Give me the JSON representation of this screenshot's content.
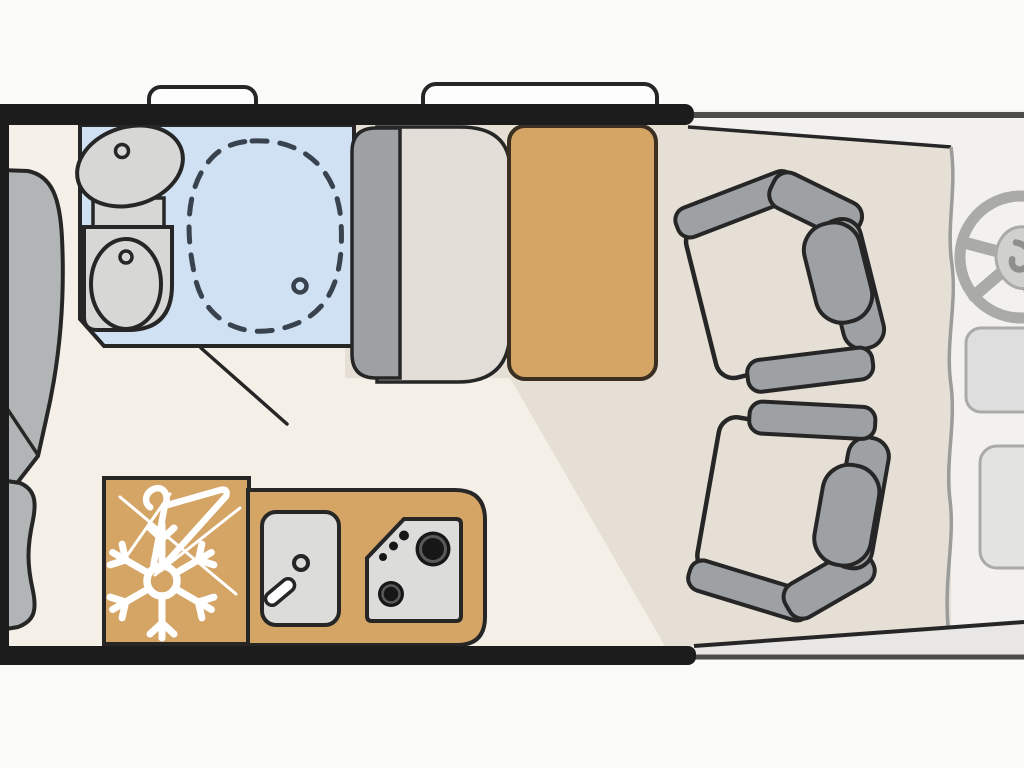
{
  "canvas": {
    "width": 1024,
    "height": 768,
    "description": "Motorhome floor plan, top view; vehicle front (cab) on the right, rear bed on the left, no visible text labels"
  },
  "palette": {
    "background": "#fbfbfa",
    "wall": "#1c1c1c",
    "outline": "#262626",
    "table_outline": "#3a2f20",
    "floor_cream": "#f5f0e7",
    "floor_beige": "#e5dfd5",
    "bathroom_blue": "#cfe1f2",
    "furniture_orange": "#d5a566",
    "seat_gray": "#9da1a3",
    "cushion_gray": "#e2ded7",
    "bed_gray": "#b2b5b5",
    "fixture_gray": "#d7d7d5",
    "appliance_steel": "#dcdcda",
    "burner_black": "#171717",
    "burner_ring": "#5a5a5a",
    "cab_gray": "#f2f1ef",
    "cab_line_gray": "#aaaaa8",
    "trim_line": "#4c4c4a",
    "edge_gray": "#9c9c9a",
    "step_gray": "#e8e7e5",
    "shower_dash": "#39424f",
    "icon_white": "#ffffff",
    "window_white": "#fdfdfd"
  },
  "regions": {
    "floorplan": {
      "label": "Motorhome floor plan, top-down view"
    },
    "bedroom": {
      "label": "Rear bed area, mattress and pillow partially visible at left edge"
    },
    "bathroom": {
      "label": "Washroom with washbasin, toilet and shower, blue floor"
    },
    "dinette": {
      "label": "Dinette bench seat with orange table"
    },
    "kitchen": {
      "label": "Kitchen block with sink and two-burner hob on orange counter"
    },
    "wardrobe_fridge": {
      "label": "Wardrobe and refrigerator cabinet marked with snowflake and coat-hanger icons"
    },
    "lounge": {
      "label": "Living area floor with two swivelled captain chairs"
    },
    "cab": {
      "label": "Driver cab with steering wheel and dashboard consoles"
    },
    "entry": {
      "label": "Entry step strip at cab door"
    }
  },
  "windows": [
    {
      "name": "rear-roof-window",
      "label": "small opened window flap on top wall"
    },
    {
      "name": "main-roof-window",
      "label": "large opened window flap on top wall"
    }
  ],
  "fixtures": [
    {
      "name": "bed-mattress",
      "label": "mattress, cut off by image edge"
    },
    {
      "name": "bed-pillow",
      "label": "pillow, cut off by image edge"
    },
    {
      "name": "washbasin",
      "label": "oval washbasin with tap dot"
    },
    {
      "name": "toilet",
      "label": "toilet with bowl and flush dot"
    },
    {
      "name": "shower-area",
      "label": "dashed shower tray outline with drain"
    },
    {
      "name": "bathroom-door-swing",
      "label": "door swing line"
    },
    {
      "name": "bench-backrest",
      "label": "dinette bench backrest"
    },
    {
      "name": "bench-cushion",
      "label": "dinette bench cushion"
    },
    {
      "name": "dinette-table",
      "label": "orange table"
    },
    {
      "name": "kitchen-sink",
      "label": "sink with drain and tap"
    },
    {
      "name": "kitchen-hob",
      "label": "hob with 2 burners and 3 control dots"
    },
    {
      "name": "captain-chair-top",
      "label": "swivel captain chair, upper"
    },
    {
      "name": "captain-chair-bottom",
      "label": "swivel captain chair, lower"
    },
    {
      "name": "steering-wheel",
      "label": "steering wheel, cut off at right edge"
    },
    {
      "name": "dashboard-console-upper",
      "label": "dashboard element"
    },
    {
      "name": "dashboard-console-lower",
      "label": "dashboard element"
    }
  ],
  "icons": [
    {
      "name": "snowflake-icon",
      "meaning": "refrigerator"
    },
    {
      "name": "hanger-icon",
      "meaning": "wardrobe / clothes rail"
    },
    {
      "name": "steering-wheel-icon",
      "meaning": "driver position"
    }
  ],
  "counts": {
    "burners": 2,
    "hob_control_dots": 3,
    "captain_chairs": 2,
    "roof_windows": 2
  }
}
